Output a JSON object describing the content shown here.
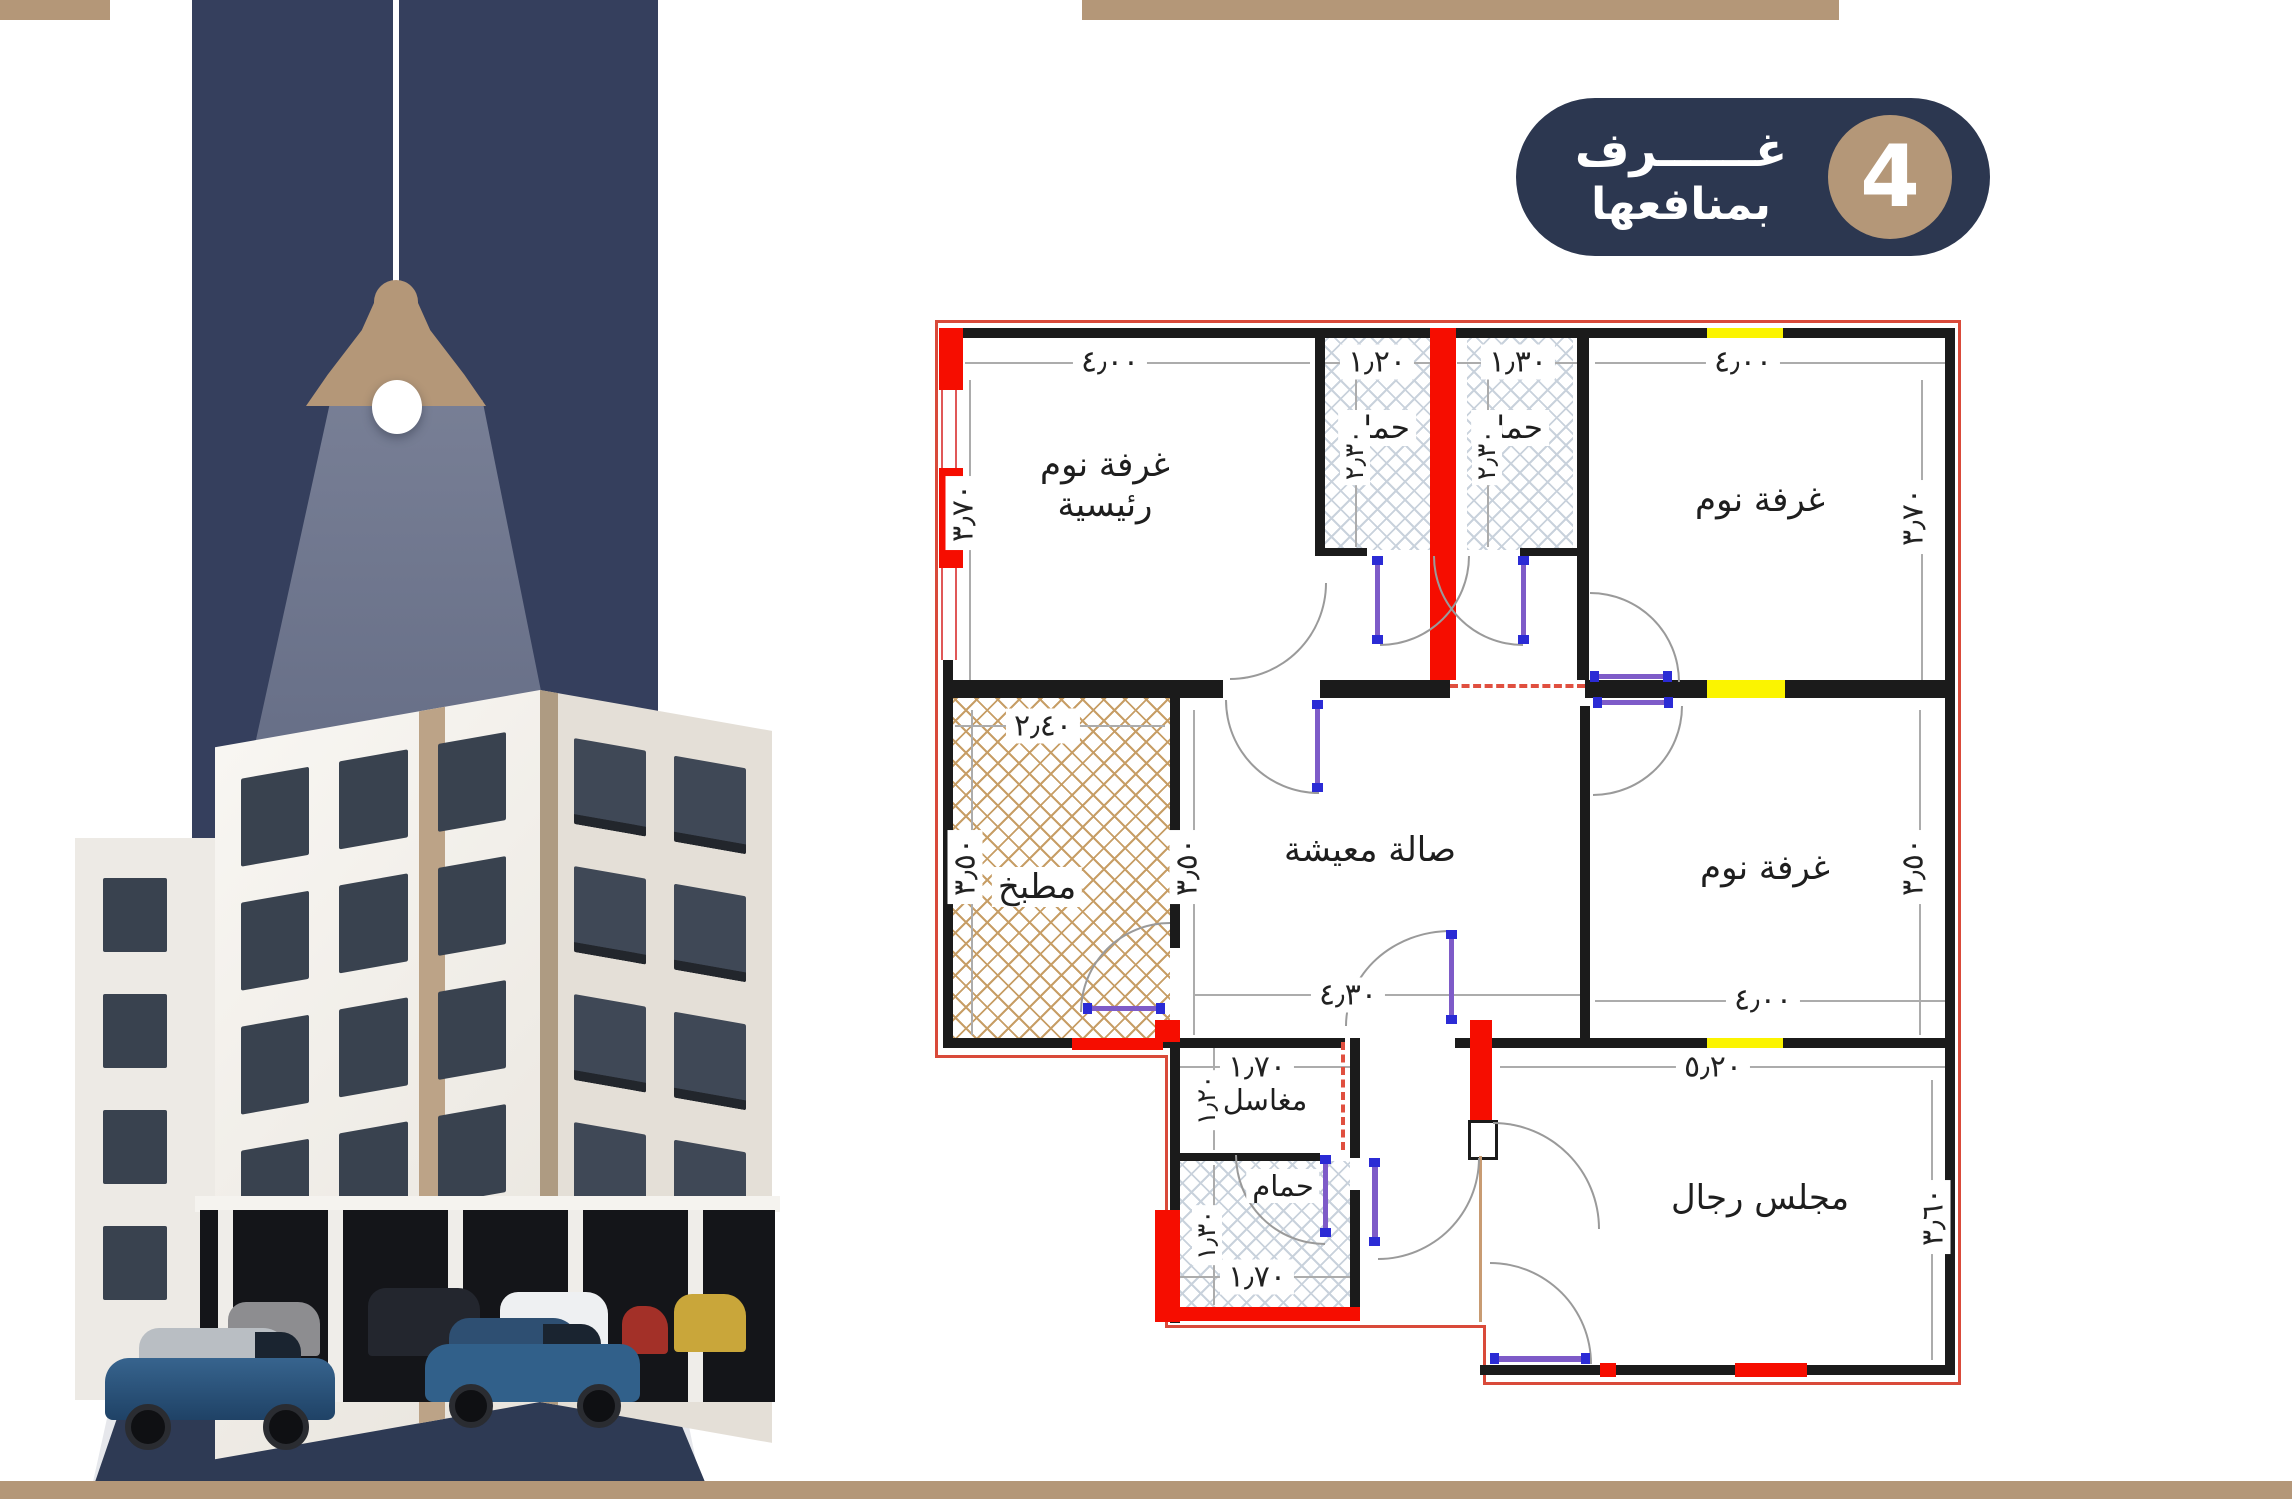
{
  "colors": {
    "navy_band": "#353F5D",
    "badge_navy": "#2C3750",
    "tan_accent": "#B49778",
    "plan_wall_red": "#F60D00",
    "plan_window_yellow": "#FBF400",
    "kitchen_hatch": "#C79E66",
    "bath_hatch": "#C9D2DC"
  },
  "badge": {
    "number": "4",
    "line1": "غــــــرف",
    "line2": "بمنافعها"
  },
  "floor_plan": {
    "rooms": {
      "master_bedroom_line1": "غرفة نوم",
      "master_bedroom_line2": "رئيسية",
      "bathroom_top_1": "حمام",
      "bathroom_top_2": "حمام",
      "bedroom_top_right": "غرفة نوم",
      "kitchen": "مطبخ",
      "living_hall": "صالة معيشة",
      "bedroom_middle_right": "غرفة نوم",
      "washbasins": "مغاسل",
      "bathroom_bottom": "حمام",
      "mens_majlis": "مجلس رجال"
    },
    "dims": {
      "master_top": "٤٫٠٠",
      "bath1_top": "١٫٢٠",
      "bath2_top": "١٫٣٠",
      "bedroom_tr_top": "٤٫٠٠",
      "master_left": "٣٫٧٠",
      "bedroom_tr_right": "٣٫٧٠",
      "bath1_depth": "٢٫٣٠",
      "bath2_depth": "٢٫٣٠",
      "kitchen_top": "٢٫٤٠",
      "kitchen_left": "٣٫٥٠",
      "living_left": "٣٫٥٠",
      "living_bottom": "٤٫٣٠",
      "bedroom_mr_bottom": "٤٫٠٠",
      "bedroom_mr_right": "٣٫٥٠",
      "majlis_top": "٥٫٢٠",
      "majlis_right": "٣٫٦٠",
      "washbasins_top": "١٫٧٠",
      "washbasins_left": "١٫٢٠",
      "bathroom_bottom_width": "١٫٧٠",
      "bathroom_bottom_left": "١٫٣٠"
    }
  }
}
